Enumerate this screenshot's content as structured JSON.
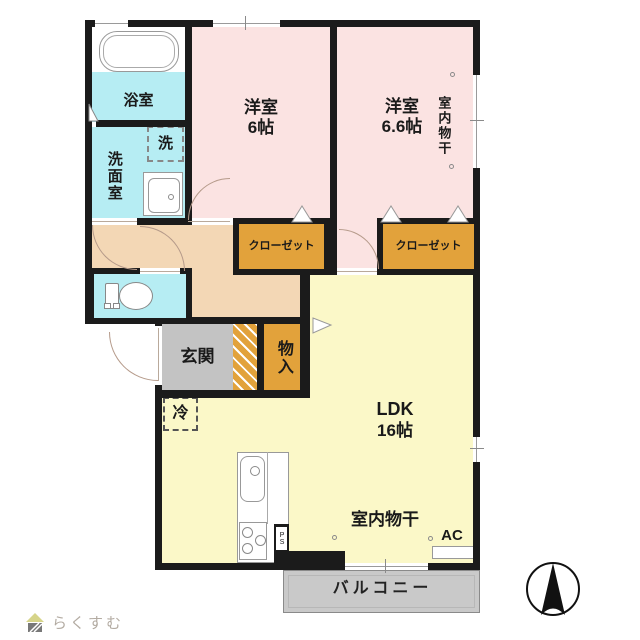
{
  "colors": {
    "wall": "#1b1b1b",
    "room-pink": "#fbe3e2",
    "room-cyan": "#b6edf3",
    "hall-peach": "#f3d7b5",
    "ldk-yellow": "#fbf8c8",
    "closet-orange": "#e2a23b",
    "genkan-gray": "#c3c3c3",
    "balcony-gray": "#c9c9c9",
    "door-arc": "#b59a8a"
  },
  "plan": {
    "bath": {
      "label": "浴室"
    },
    "washroom": {
      "label": "洗面室"
    },
    "washer": {
      "label": "洗"
    },
    "bedroom1": {
      "label": "洋室",
      "size": "6帖"
    },
    "bedroom2": {
      "label": "洋室",
      "size": "6.6帖",
      "drying": "室内物干"
    },
    "closet1": {
      "label": "クローゼット"
    },
    "closet2": {
      "label": "クローゼット"
    },
    "genkan": {
      "label": "玄関"
    },
    "storage": {
      "label": "物入"
    },
    "fridge": {
      "label": "冷"
    },
    "ldk": {
      "label": "LDK",
      "size": "16帖",
      "drying": "室内物干",
      "ac": "AC",
      "ps": "PS"
    },
    "balcony": {
      "label": "バルコニー"
    }
  },
  "footer": {
    "logo_text": "らくすむ"
  }
}
